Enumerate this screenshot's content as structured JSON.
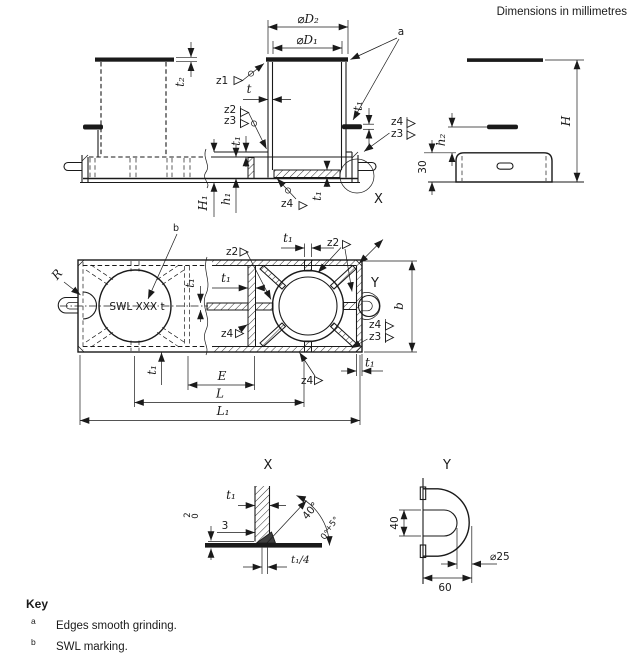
{
  "note": "Dimensions in millimetres",
  "colors": {
    "ink": "#1a1a1a",
    "background": "#ffffff"
  },
  "front_view": {
    "dia_d2": "⌀D₂",
    "dia_d1": "⌀D₁",
    "ref_a": "a",
    "t2": "t₂",
    "z1": "z1",
    "t": "t",
    "z2": "z2",
    "z3": "z3",
    "t1": "t₁",
    "z4": "z4",
    "h1_total": "H₁",
    "h1_inner": "h₁",
    "detail_ref": "X"
  },
  "side_view": {
    "h": "H",
    "h2": "h₂",
    "dim_30": "30"
  },
  "plan_view": {
    "ref_b": "b",
    "swl_marking": "SWL XXX t",
    "r": "R",
    "z2": "z2",
    "z3": "z3",
    "z4": "z4",
    "t1": "t₁",
    "b": "b",
    "e": "E",
    "l": "L",
    "l1": "L₁",
    "detail_ref": "Y"
  },
  "detail_x": {
    "title": "X",
    "t1": "t₁",
    "dim_3": "3",
    "gap_upper": "2",
    "gap_lower": "0",
    "angle": "40°",
    "angle_tol_plus": "+5°",
    "angle_tol_zero": "0°",
    "t1_over_4": "t₁/4"
  },
  "detail_y": {
    "title": "Y",
    "dim_40": "40",
    "dia_25": "⌀25",
    "dim_60": "60"
  },
  "key": {
    "title": "Key",
    "items": [
      {
        "ref": "a",
        "text": "Edges smooth grinding."
      },
      {
        "ref": "b",
        "text": "SWL marking."
      }
    ]
  }
}
